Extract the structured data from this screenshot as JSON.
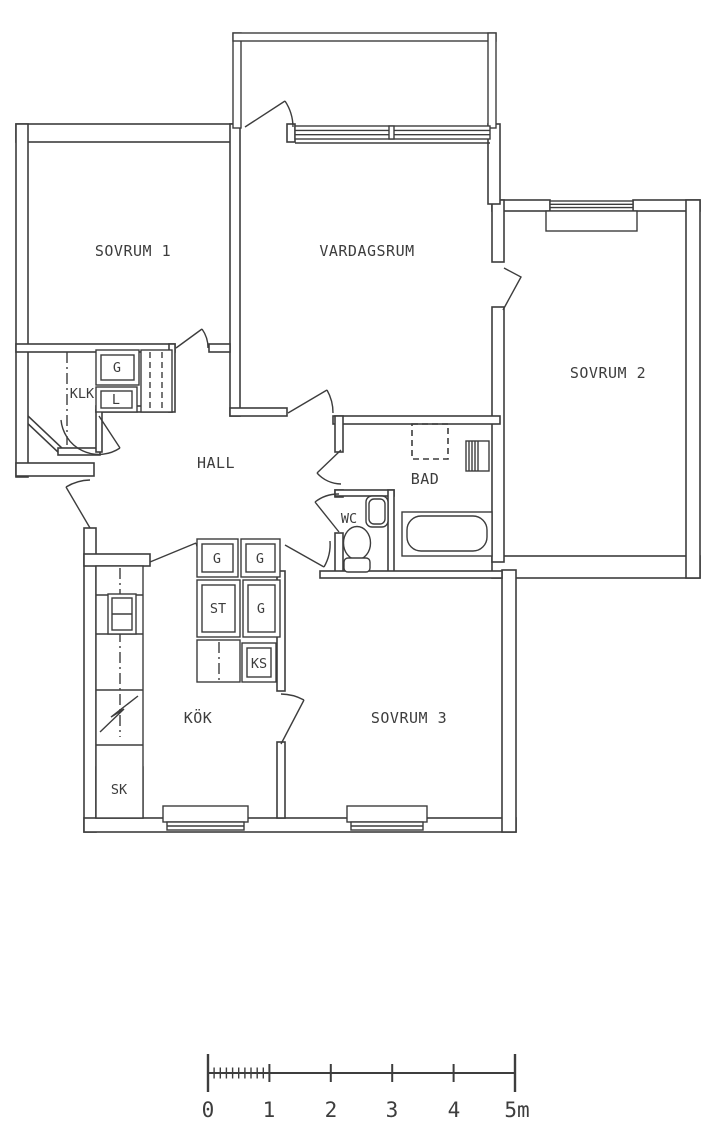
{
  "rooms": {
    "sovrum_1": "SOVRUM 1",
    "vardagsrum": "VARDAGSRUM",
    "sovrum_2": "SOVRUM 2",
    "hall": "HALL",
    "bad": "BAD",
    "wc": "WC",
    "kok": "KÖK",
    "sovrum_3": "SOVRUM 3"
  },
  "storage": {
    "klk": "KLK",
    "g_hall": "G",
    "l_hall": "L",
    "g_top_left": "G",
    "g_top_right": "G",
    "st": "ST",
    "g_mid": "G",
    "ks": "KS",
    "sk": "SK"
  },
  "scale_bar": {
    "labels": [
      "0",
      "1",
      "2",
      "3",
      "4",
      "5m"
    ]
  },
  "colors": {
    "line": "#3d3d3d",
    "background": "#ffffff"
  }
}
